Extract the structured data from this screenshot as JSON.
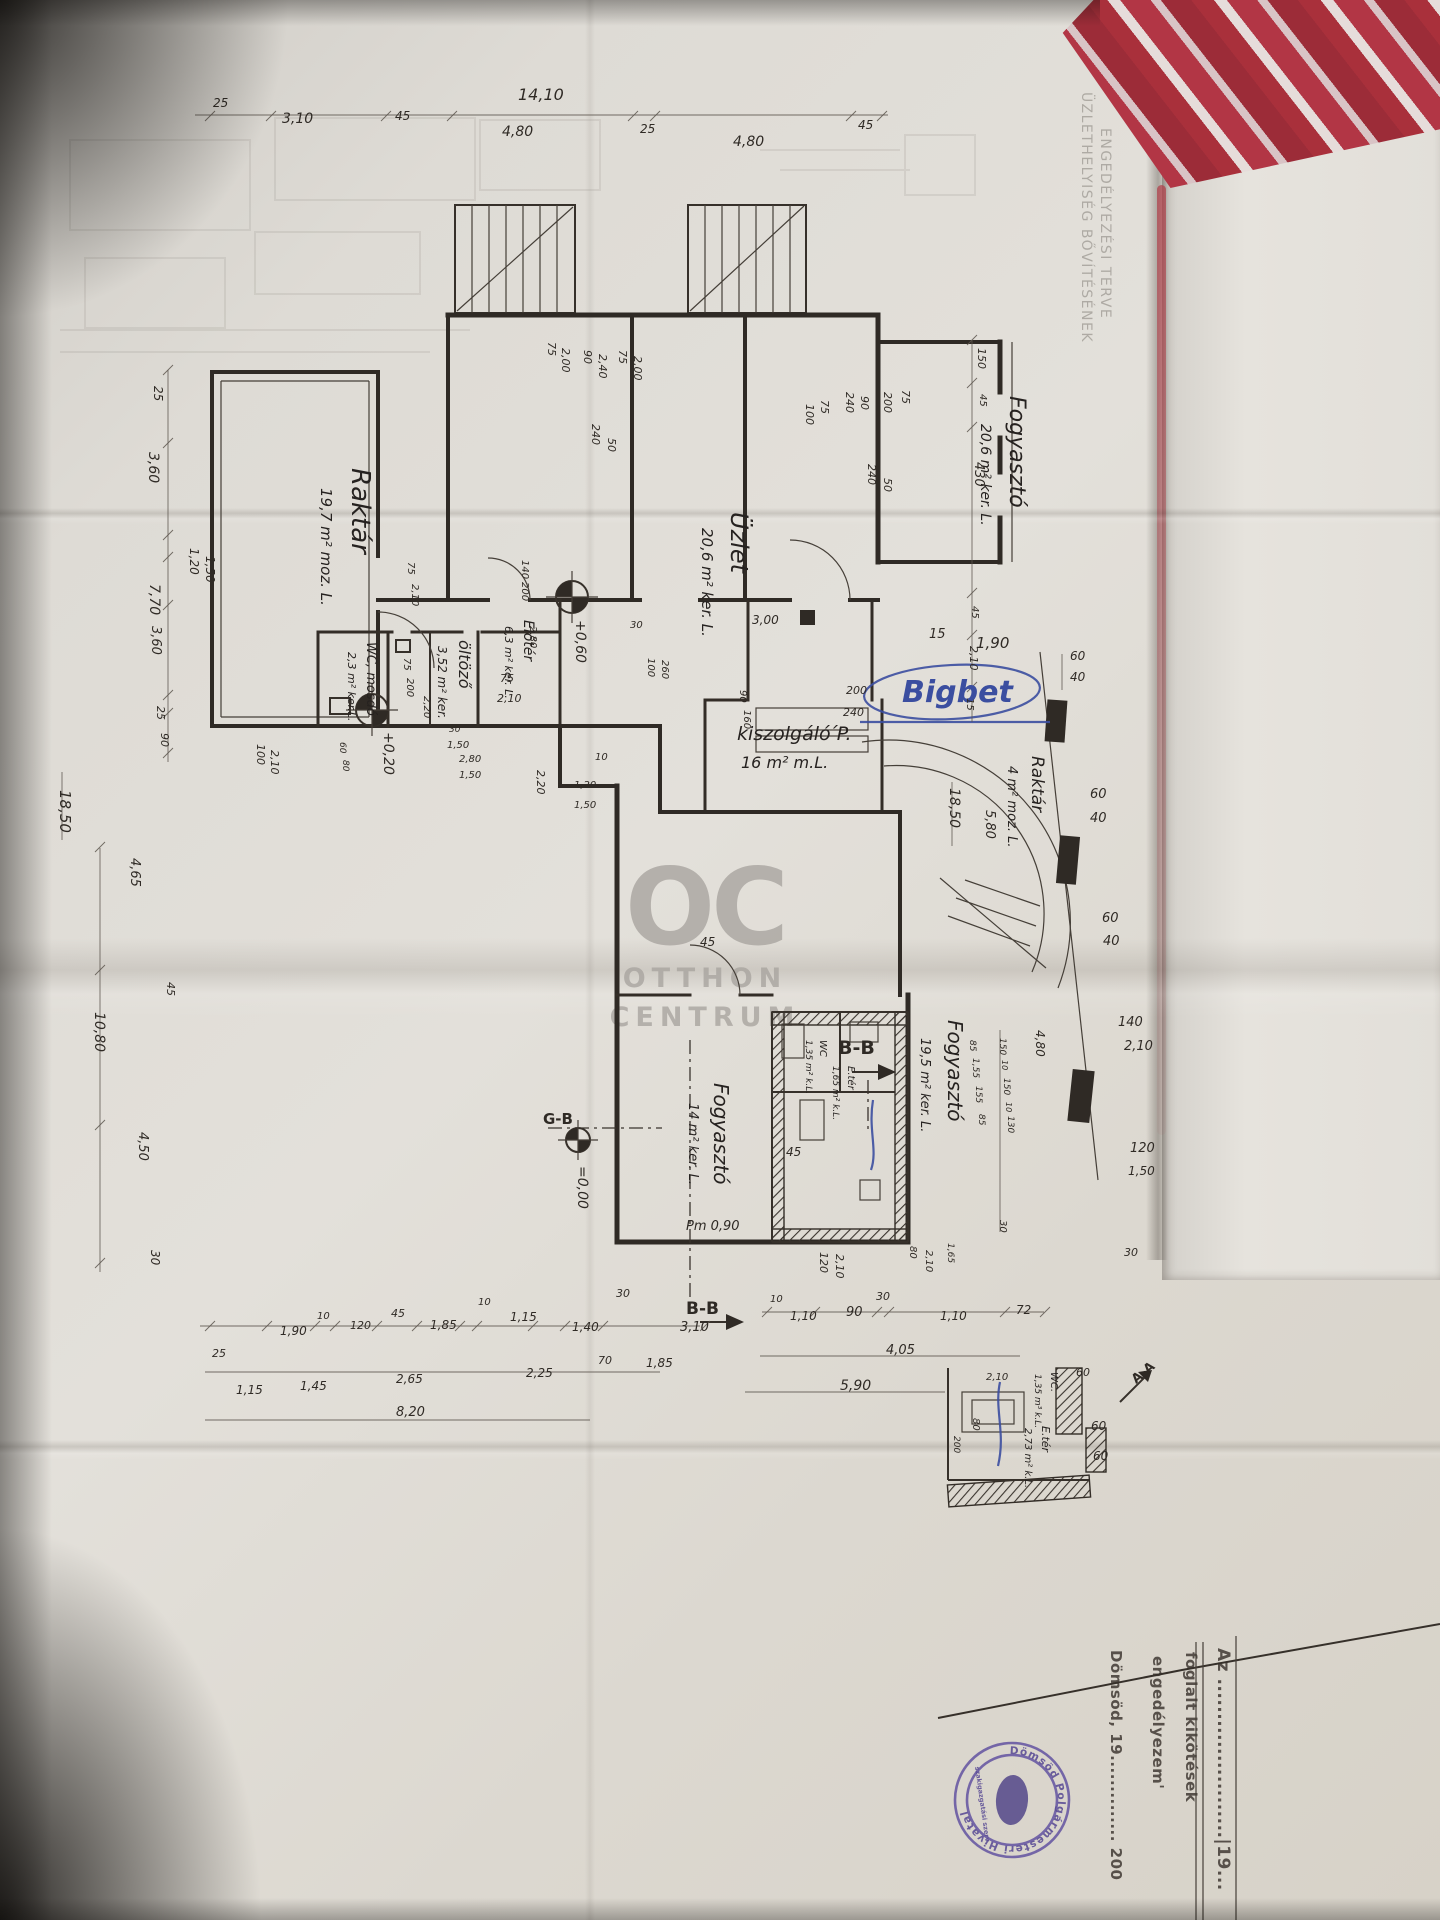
{
  "colors": {
    "fabric_red": "#b23340",
    "ink": "#2f2a25",
    "blue_ink": "#3b4ea0",
    "stamp_purple": "#6152a0",
    "paper": "#dcd9d3"
  },
  "watermark": {
    "logo": "OC",
    "line1": "OTTHON",
    "line2": "CENTRUM"
  },
  "title_block": {
    "stamp_ring": "Dömsöd Polgármesteri Hivatal",
    "stamp_inner": "szakigazgatási szerv",
    "labels": [
      [
        "ÜZLETHELYISÉG BŐVÍTÉSÉNEK",
        1082,
        92,
        90,
        14,
        "ghost"
      ],
      [
        "ENGEDÉLYEZÉSI TERVE",
        1101,
        128,
        90,
        14,
        "ghost"
      ],
      [
        "Az .......................|19...",
        1218,
        1648,
        90,
        17,
        "permit"
      ],
      [
        "foglalt  kikötések",
        1186,
        1652,
        90,
        15,
        "permit"
      ],
      [
        "engedélyezem'",
        1153,
        1656,
        90,
        15,
        "permit"
      ],
      [
        "Dömsöd, 19..............  200",
        1111,
        1650,
        90,
        15,
        "permit"
      ]
    ]
  },
  "plan": {
    "labels": [
      [
        "Raktár",
        352,
        468,
        90,
        26,
        "room"
      ],
      [
        "19,7 m² moz. L.",
        321,
        488,
        90,
        15,
        "room"
      ],
      [
        "Üzlet",
        731,
        512,
        90,
        24,
        "room"
      ],
      [
        "20,6 m² ker. L.",
        702,
        528,
        90,
        15,
        "room"
      ],
      [
        "Fogyasztó",
        1010,
        396,
        90,
        22,
        "room"
      ],
      [
        "20,6 m² ker. L.",
        981,
        424,
        90,
        14,
        "room"
      ],
      [
        "Raktár",
        1032,
        756,
        90,
        17,
        "room"
      ],
      [
        "4 m² moz. L.",
        1008,
        766,
        90,
        13,
        "room"
      ],
      [
        "kiszolgáló ́P.",
        737,
        740,
        0,
        19,
        "room"
      ],
      [
        "16 m² m.L.",
        741,
        768,
        0,
        16,
        "room"
      ],
      [
        "Fogyasztó",
        948,
        1020,
        90,
        20,
        "room"
      ],
      [
        "19,5 m² ker. L.",
        921,
        1038,
        90,
        13,
        "room"
      ],
      [
        "Fogyasztó",
        714,
        1083,
        90,
        20,
        "room"
      ],
      [
        "14 m² ker. L.",
        689,
        1103,
        90,
        13,
        "room"
      ],
      [
        "öltöző",
        459,
        640,
        90,
        16,
        "room"
      ],
      [
        "3,52 m² ker.",
        438,
        646,
        90,
        12,
        "room"
      ],
      [
        "WC, mosdó",
        367,
        642,
        90,
        13,
        "room"
      ],
      [
        "2,3 m² ker.L.",
        348,
        652,
        90,
        11,
        "room"
      ],
      [
        "Előtér",
        524,
        620,
        90,
        14,
        "room"
      ],
      [
        "6,3 m² ker. L.",
        505,
        626,
        90,
        11,
        "room"
      ],
      [
        "E.tér",
        1042,
        1426,
        90,
        11,
        "room"
      ],
      [
        "2,73 m² k.L.",
        1025,
        1428,
        90,
        10,
        "room"
      ],
      [
        "WC.",
        1051,
        1372,
        90,
        10,
        "room"
      ],
      [
        "1,35 m³ k.L.",
        1035,
        1374,
        90,
        9,
        "room"
      ],
      [
        "WC",
        820,
        1040,
        90,
        10,
        "room"
      ],
      [
        "1,35 m² k.L.",
        806,
        1040,
        90,
        9,
        "room"
      ],
      [
        "E.tér",
        848,
        1066,
        90,
        10,
        "room"
      ],
      [
        "1,65 m² k.L.",
        833,
        1066,
        90,
        9,
        "room"
      ],
      [
        "B-B",
        838,
        1054,
        0,
        19,
        "sec"
      ],
      [
        "B-B",
        686,
        1314,
        0,
        17,
        "sec"
      ],
      [
        "A-A",
        1136,
        1384,
        -40,
        13,
        "sec"
      ],
      [
        "G-B",
        543,
        1124,
        0,
        15,
        "sec"
      ],
      [
        "=0,00",
        578,
        1166,
        90,
        14
      ],
      [
        "+0,60",
        576,
        620,
        90,
        14
      ],
      [
        "+0,20",
        384,
        732,
        90,
        14
      ],
      [
        "Pm 0,90",
        686,
        1230,
        0,
        13
      ],
      [
        "15",
        929,
        638,
        0,
        13
      ],
      [
        "1,90",
        976,
        648,
        0,
        15
      ],
      [
        "Bigbet",
        902,
        702,
        0,
        30,
        "blue"
      ],
      [
        "14,10",
        518,
        100,
        0,
        16
      ],
      [
        "25",
        213,
        107,
        0,
        12
      ],
      [
        "3,10",
        282,
        123,
        0,
        14
      ],
      [
        "45",
        395,
        120,
        0,
        12
      ],
      [
        "4,80",
        502,
        136,
        0,
        14
      ],
      [
        "25",
        640,
        133,
        0,
        12
      ],
      [
        "4,80",
        733,
        146,
        0,
        14
      ],
      [
        "45",
        858,
        129,
        0,
        12
      ],
      [
        "25",
        154,
        386,
        90,
        12
      ],
      [
        "3,60",
        149,
        452,
        90,
        14
      ],
      [
        "1,20",
        190,
        548,
        90,
        12
      ],
      [
        "1,50",
        206,
        556,
        90,
        12
      ],
      [
        "7,70",
        150,
        584,
        90,
        14
      ],
      [
        "3,60",
        152,
        626,
        90,
        13
      ],
      [
        "25",
        157,
        706,
        90,
        11
      ],
      [
        "90",
        161,
        733,
        90,
        11
      ],
      [
        "100",
        257,
        744,
        90,
        11
      ],
      [
        "2,10",
        271,
        750,
        90,
        11
      ],
      [
        "18,50",
        60,
        790,
        90,
        15
      ],
      [
        "4,65",
        131,
        858,
        90,
        13
      ],
      [
        "45",
        167,
        982,
        90,
        11
      ],
      [
        "10,80",
        95,
        1012,
        90,
        14
      ],
      [
        "4,50",
        139,
        1132,
        90,
        13
      ],
      [
        "30",
        151,
        1250,
        90,
        12
      ],
      [
        "150",
        978,
        348,
        90,
        11
      ],
      [
        "45",
        980,
        394,
        90,
        10
      ],
      [
        "430",
        975,
        462,
        90,
        13
      ],
      [
        "45",
        972,
        606,
        90,
        10
      ],
      [
        "2,10",
        970,
        646,
        90,
        11
      ],
      [
        "15",
        967,
        698,
        90,
        10
      ],
      [
        "18,50",
        950,
        788,
        90,
        14
      ],
      [
        "5,80",
        986,
        810,
        90,
        13
      ],
      [
        "60",
        1070,
        660,
        0,
        12
      ],
      [
        "40",
        1070,
        681,
        0,
        12
      ],
      [
        "60",
        1090,
        798,
        0,
        13
      ],
      [
        "40",
        1090,
        822,
        0,
        13
      ],
      [
        "60",
        1102,
        922,
        0,
        13
      ],
      [
        "40",
        1103,
        945,
        0,
        13
      ],
      [
        "140",
        1118,
        1026,
        0,
        13
      ],
      [
        "2,10",
        1124,
        1050,
        0,
        13
      ],
      [
        "120",
        1130,
        1152,
        0,
        13
      ],
      [
        "1,50",
        1128,
        1175,
        0,
        12
      ],
      [
        "4,80",
        1036,
        1030,
        90,
        12
      ],
      [
        "150",
        1000,
        1038,
        90,
        9
      ],
      [
        "10",
        1002,
        1060,
        90,
        8
      ],
      [
        "150",
        1004,
        1078,
        90,
        9
      ],
      [
        "10",
        1006,
        1102,
        90,
        8
      ],
      [
        "130",
        1008,
        1116,
        90,
        9
      ],
      [
        "85",
        970,
        1040,
        90,
        9
      ],
      [
        "1,55",
        973,
        1058,
        90,
        9
      ],
      [
        "155",
        976,
        1086,
        90,
        9
      ],
      [
        "85",
        979,
        1114,
        90,
        9
      ],
      [
        "30",
        1000,
        1220,
        90,
        10
      ],
      [
        "30",
        1124,
        1256,
        0,
        11
      ],
      [
        "75",
        548,
        342,
        90,
        11
      ],
      [
        "2,00",
        562,
        348,
        90,
        11
      ],
      [
        "90",
        584,
        350,
        90,
        11
      ],
      [
        "2,40",
        599,
        354,
        90,
        11
      ],
      [
        "75",
        619,
        350,
        90,
        11
      ],
      [
        "2,00",
        634,
        356,
        90,
        11
      ],
      [
        "240",
        592,
        424,
        90,
        11
      ],
      [
        "50",
        608,
        438,
        90,
        11
      ],
      [
        "100",
        806,
        404,
        90,
        11
      ],
      [
        "75",
        821,
        400,
        90,
        11
      ],
      [
        "240",
        846,
        392,
        90,
        11
      ],
      [
        "90",
        861,
        396,
        90,
        11
      ],
      [
        "200",
        884,
        392,
        90,
        11
      ],
      [
        "75",
        902,
        390,
        90,
        11
      ],
      [
        "240",
        868,
        464,
        90,
        11
      ],
      [
        "50",
        884,
        478,
        90,
        11
      ],
      [
        "100",
        648,
        658,
        90,
        10
      ],
      [
        "260",
        662,
        660,
        90,
        10
      ],
      [
        "90",
        740,
        690,
        90,
        10
      ],
      [
        "160",
        744,
        710,
        90,
        10
      ],
      [
        "200",
        846,
        694,
        0,
        11
      ],
      [
        "240",
        843,
        716,
        0,
        11
      ],
      [
        "3,00",
        752,
        624,
        0,
        12
      ],
      [
        "30",
        630,
        628,
        0,
        10
      ],
      [
        "140",
        522,
        560,
        90,
        10
      ],
      [
        "200",
        522,
        582,
        90,
        10
      ],
      [
        "2,80",
        530,
        626,
        90,
        10
      ],
      [
        "75",
        408,
        562,
        90,
        10
      ],
      [
        "2,10",
        412,
        584,
        90,
        10
      ],
      [
        "75",
        500,
        682,
        0,
        11
      ],
      [
        "2,10",
        497,
        702,
        0,
        11
      ],
      [
        "2,20",
        537,
        770,
        90,
        11
      ],
      [
        "2,20",
        424,
        696,
        90,
        10
      ],
      [
        "10",
        595,
        760,
        0,
        10
      ],
      [
        "75",
        404,
        658,
        90,
        10
      ],
      [
        "200",
        407,
        678,
        90,
        10
      ],
      [
        "30",
        449,
        732,
        0,
        9
      ],
      [
        "1,50",
        447,
        748,
        0,
        10
      ],
      [
        "60",
        340,
        742,
        90,
        9
      ],
      [
        "80",
        343,
        760,
        90,
        9
      ],
      [
        "2,80",
        459,
        762,
        0,
        10
      ],
      [
        "1,50",
        459,
        778,
        0,
        10
      ],
      [
        "1,20",
        574,
        788,
        0,
        10
      ],
      [
        "1,50",
        574,
        808,
        0,
        10
      ],
      [
        "45",
        700,
        946,
        0,
        12
      ],
      [
        "45",
        786,
        1156,
        0,
        12
      ],
      [
        "120",
        820,
        1252,
        90,
        11
      ],
      [
        "2,10",
        836,
        1254,
        90,
        11
      ],
      [
        "80",
        910,
        1246,
        90,
        10
      ],
      [
        "2,10",
        926,
        1250,
        90,
        10
      ],
      [
        "1,65",
        948,
        1243,
        90,
        9
      ],
      [
        "60",
        1076,
        1376,
        0,
        11
      ],
      [
        "2,10",
        986,
        1380,
        0,
        10
      ],
      [
        "80",
        973,
        1418,
        90,
        10
      ],
      [
        "200",
        954,
        1436,
        90,
        9
      ],
      [
        "60",
        1091,
        1430,
        0,
        12
      ],
      [
        "60",
        1093,
        1460,
        0,
        12
      ],
      [
        "10",
        770,
        1302,
        0,
        10
      ],
      [
        "1,10",
        790,
        1320,
        0,
        12
      ],
      [
        "90",
        846,
        1316,
        0,
        13
      ],
      [
        "30",
        876,
        1300,
        0,
        11
      ],
      [
        "1,10",
        940,
        1320,
        0,
        12
      ],
      [
        "72",
        1016,
        1314,
        0,
        12
      ],
      [
        "4,05",
        886,
        1354,
        0,
        13
      ],
      [
        "5,90",
        840,
        1390,
        0,
        14
      ],
      [
        "3,10",
        680,
        1331,
        0,
        13
      ],
      [
        "30",
        616,
        1297,
        0,
        11
      ],
      [
        "1,40",
        572,
        1331,
        0,
        12
      ],
      [
        "70",
        598,
        1364,
        0,
        11
      ],
      [
        "1,85",
        646,
        1367,
        0,
        12
      ],
      [
        "1,15",
        510,
        1321,
        0,
        12
      ],
      [
        "10",
        478,
        1305,
        0,
        10
      ],
      [
        "2,25",
        526,
        1377,
        0,
        12
      ],
      [
        "1,85",
        430,
        1329,
        0,
        12
      ],
      [
        "45",
        391,
        1317,
        0,
        11
      ],
      [
        "120",
        350,
        1329,
        0,
        11
      ],
      [
        "10",
        317,
        1319,
        0,
        10
      ],
      [
        "1,90",
        280,
        1335,
        0,
        12
      ],
      [
        "25",
        212,
        1357,
        0,
        11
      ],
      [
        "2,65",
        396,
        1383,
        0,
        12
      ],
      [
        "1,45",
        300,
        1390,
        0,
        12
      ],
      [
        "1,15",
        236,
        1394,
        0,
        12
      ],
      [
        "8,20",
        396,
        1416,
        0,
        13
      ]
    ]
  }
}
